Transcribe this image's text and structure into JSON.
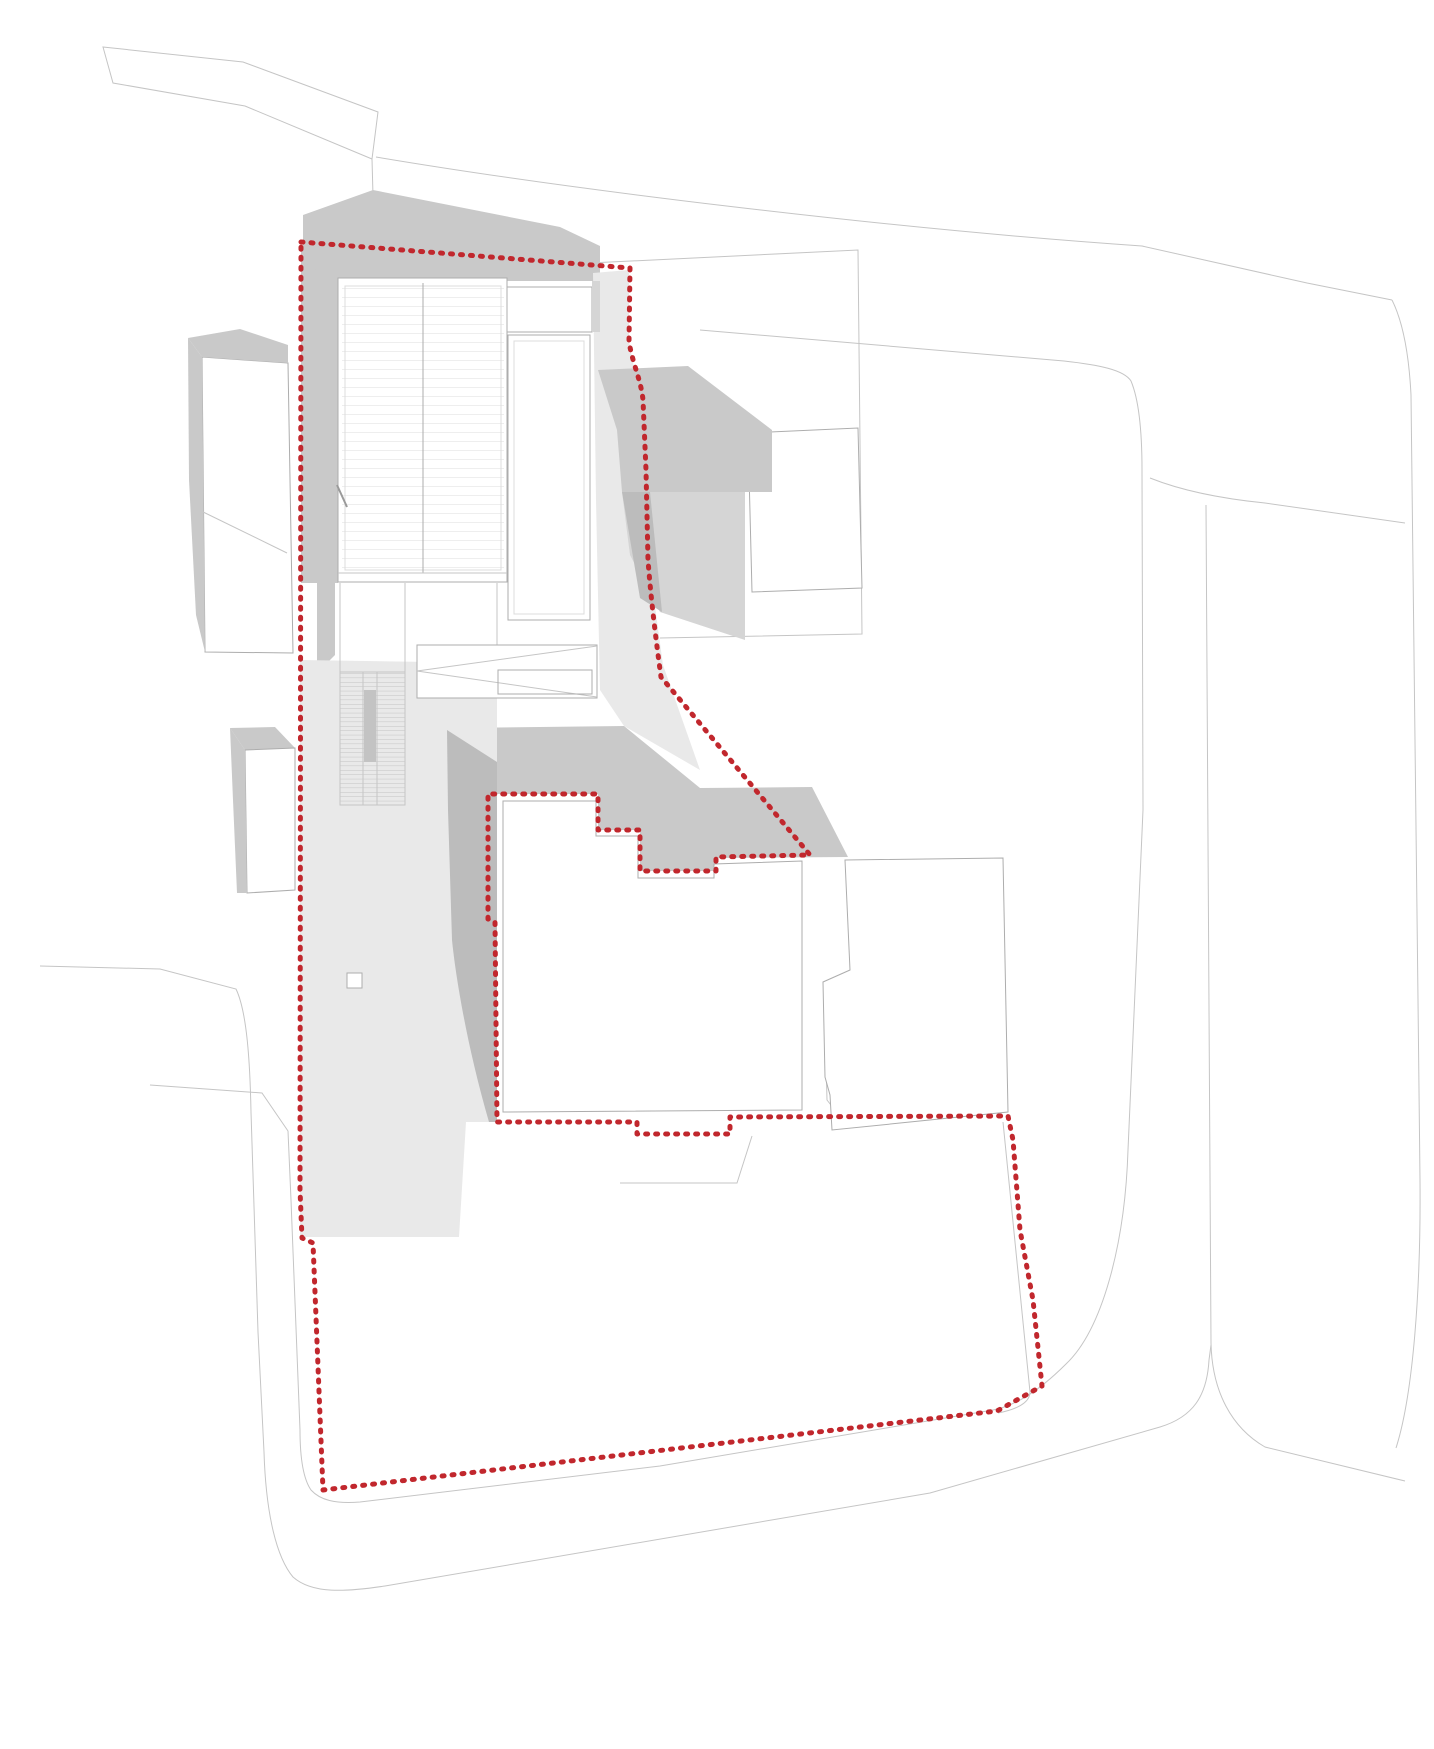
{
  "title": "architectural-site-plan",
  "canvas": {
    "width": 1434,
    "height": 1749,
    "background": "#ffffff"
  },
  "colors": {
    "boundary_red": "#c1272d",
    "outline_thin": "#c5c5c5",
    "outline_building": "#adadad",
    "mass_gray": "#c9c9c9",
    "mass_gray_dark": "#bcbcbc",
    "mass_gray_mid": "#d5d5d5",
    "plaza_light": "#e9e9e9",
    "roof_hatch": "#dcdcdc",
    "stair_tread": "#c3c3c3",
    "white": "#ffffff"
  },
  "legend": {
    "site_boundary_style": "red dashed dotted line",
    "boundary_dash": "2 8",
    "boundary_width": 5
  },
  "shapes": [
    {
      "name": "road-top-strip",
      "kind": "thin",
      "d": "M103,47 L243,62 L378,112 L372,159 L245,106 L113,83 Z"
    },
    {
      "name": "road-top-strip-stub",
      "kind": "thin",
      "d": "M372,159 L374,232"
    },
    {
      "name": "road-north-upper-edge",
      "kind": "thin",
      "d": "M376,157 C560,188 880,228 1142,246 L1307,283 L1392,300"
    },
    {
      "name": "road-east-outer-edge",
      "kind": "thin",
      "d": "M1392,300 C1403,322 1409,355 1411,395 L1418,1000 L1420,1180 C1421,1290 1413,1395 1396,1448"
    },
    {
      "name": "parcel-line-northeast",
      "kind": "thin",
      "d": "M590,263 L858,250 L862,634 L660,638"
    },
    {
      "name": "road-inner-loop",
      "kind": "thin",
      "d": "M700,330 L1064,361 C1100,365 1124,370 1131,381 C1139,400 1142,430 1142,470 L1143,810 L1128,1150 C1125,1245 1102,1330 1066,1364 C1040,1390 1015,1406 993,1410 L660,1466 L360,1502 C335,1504 320,1500 311,1490 C302,1477 300,1450 300,1430 L291,1200 L288,1131 L262,1093 L150,1085"
    },
    {
      "name": "road-east-branch",
      "kind": "thin",
      "d": "M1150,478 C1185,492 1225,499 1265,503 L1405,523"
    },
    {
      "name": "road-east-second-edge",
      "kind": "thin",
      "d": "M1206,505 L1211,1343 C1212,1392 1232,1428 1265,1447 L1405,1481"
    },
    {
      "name": "road-outer-west-south",
      "kind": "thin",
      "d": "M40,966 L160,969 L236,989 C247,1012 250,1062 251,1112 L258,1332 L264,1452 C266,1516 277,1558 293,1577 C312,1594 345,1592 385,1586 L930,1493 L1160,1427 C1193,1417 1207,1396 1209,1360 L1211,1345"
    },
    {
      "name": "parcel-line-southeast",
      "kind": "thin",
      "d": "M1003,1122 L1030,1392 C1030,1402 1018,1409 998,1413"
    },
    {
      "name": "parcel-stub-south-a",
      "kind": "thin",
      "d": "M620,1183 L737,1183 L752,1136"
    },
    {
      "name": "parcel-stub-south-b",
      "kind": "thin",
      "d": "M825,1021 L827,1100 L845,1123"
    },
    {
      "name": "shadow-west-strip",
      "kind": "fill",
      "fill": "mass_gray",
      "d": "M301,245 L338,249 L338,583 L301,583 Z"
    },
    {
      "name": "shadow-west-wedge",
      "kind": "fill",
      "fill": "mass_gray",
      "d": "M317,583 L335,583 L335,655 L327,663 L317,663 Z"
    },
    {
      "name": "shadow-north-peak",
      "kind": "fill",
      "fill": "mass_gray",
      "d": "M303,262 L303,215 L373,190 L560,227 L600,246 L600,281 L338,281 L338,278 L320,272 Z"
    },
    {
      "name": "plaza-east-strip",
      "kind": "fill",
      "fill": "plaza_light",
      "d": "M593,273 L629,270 L629,342 L646,430 L650,570 L663,665 L700,770 L624,726 L600,690 L596,500 Z"
    },
    {
      "name": "house-east-upper",
      "kind": "fillstroke",
      "fill": "white",
      "stroke": "outline_building",
      "d": "M748,433 L858,428 L862,588 L752,592 Z"
    },
    {
      "name": "shadow-east-block",
      "kind": "fill",
      "fill": "mass_gray",
      "d": "M598,370 L688,366 L772,430 L772,492 L622,492 L617,430 Z"
    },
    {
      "name": "shadow-east-light",
      "kind": "fill",
      "fill": "mass_gray_mid",
      "d": "M622,492 L745,492 L745,640 L660,612 L630,555 Z"
    },
    {
      "name": "shadow-east-dark-strip",
      "kind": "fill",
      "fill": "mass_gray_dark",
      "d": "M622,492 L650,492 L662,612 L640,598 Z"
    },
    {
      "name": "shadow-inner-north-band",
      "kind": "fill",
      "fill": "mass_gray",
      "d": "M453,728 L624,726 L700,788 L812,787 L848,857 L716,858 L716,871 L640,871 L640,830 L598,830 L598,794 L488,794 L468,778 Z"
    },
    {
      "name": "plaza-main",
      "kind": "fill",
      "fill": "plaza_light",
      "d": "M300,660 L497,663 L497,1122 L466,1122 L459,1237 L300,1237 Z"
    },
    {
      "name": "shadow-inner-west-wedge",
      "kind": "fill",
      "fill": "mass_gray_dark",
      "d": "M447,730 L497,762 L497,1122 L489,1122 C468,1050 456,980 452,940 L448,810 Z"
    },
    {
      "name": "building-a-face",
      "kind": "fillstroke",
      "fill": "white",
      "stroke": "outline_building",
      "d": "M202,357 L288,363 L293,653 L205,652 Z"
    },
    {
      "name": "building-a-roofline",
      "kind": "thin",
      "d": "M197,509 L287,553"
    },
    {
      "name": "building-a-top-shadow",
      "kind": "fill",
      "fill": "mass_gray",
      "d": "M188,338 L240,329 L288,345 L288,363 L202,357 Z"
    },
    {
      "name": "building-a-left-shadow",
      "kind": "fill",
      "fill": "mass_gray",
      "d": "M188,338 L202,357 L205,652 L196,615 L189,480 Z"
    },
    {
      "name": "building-b-top-shadow",
      "kind": "fill",
      "fill": "mass_gray",
      "d": "M230,728 L275,727 L295,748 L245,750 Z"
    },
    {
      "name": "building-b-face",
      "kind": "fillstroke",
      "fill": "white",
      "stroke": "outline_building",
      "d": "M245,750 L295,748 L295,890 L247,893 Z"
    },
    {
      "name": "building-b-left-shadow",
      "kind": "fill",
      "fill": "mass_gray",
      "d": "M230,728 L245,750 L247,893 L237,893 L233,800 Z"
    },
    {
      "name": "main-building-body",
      "kind": "fillstroke",
      "fill": "white",
      "stroke": "outline_building",
      "d": "M338,278 L507,278 L507,582 L338,582 Z"
    },
    {
      "name": "main-building-roof-hatch",
      "kind": "hatch",
      "d": "M342,283 L504,283 L504,573 L342,573 Z"
    },
    {
      "name": "main-building-parapet",
      "kind": "thinstroke",
      "stroke": "roof_hatch",
      "d": "M345,286 L501,286 L501,570 L345,570 Z"
    },
    {
      "name": "main-building-ridge",
      "kind": "thinstroke",
      "stroke": "outline_building",
      "d": "M423,283 L423,573"
    },
    {
      "name": "main-building-south-line",
      "kind": "thin",
      "d": "M338,573 L507,573"
    },
    {
      "name": "east-wing-top",
      "kind": "fillstroke",
      "fill": "white",
      "stroke": "outline_building",
      "d": "M507,287 L592,287 L592,332 L507,332 Z"
    },
    {
      "name": "east-wing-body",
      "kind": "fillstroke",
      "fill": "white",
      "stroke": "outline_building",
      "d": "M508,335 L590,335 L590,620 L508,620 Z"
    },
    {
      "name": "east-wing-inner",
      "kind": "thinstroke",
      "stroke": "roof_hatch",
      "d": "M514,341 L584,341 L584,614 L514,614 Z"
    },
    {
      "name": "east-wing-seam",
      "kind": "fill",
      "fill": "mass_gray_mid",
      "d": "M592,281 L600,281 L600,332 L592,332 Z"
    },
    {
      "name": "terrace-edge-a",
      "kind": "thin",
      "d": "M340,583 L340,672"
    },
    {
      "name": "terrace-edge-b",
      "kind": "thin",
      "d": "M405,583 L405,805"
    },
    {
      "name": "terrace-edge-c",
      "kind": "thin",
      "d": "M497,583 L497,663"
    },
    {
      "name": "canopy-plate",
      "kind": "fillstroke",
      "fill": "white",
      "stroke": "outline_building",
      "d": "M417,645 L597,645 L597,698 L417,698 Z"
    },
    {
      "name": "canopy-fold-a",
      "kind": "thin",
      "d": "M417,671 L597,646"
    },
    {
      "name": "canopy-fold-b",
      "kind": "thin",
      "d": "M417,671 L597,697"
    },
    {
      "name": "canopy-inner",
      "kind": "thinstroke",
      "stroke": "outline_building",
      "d": "M498,670 L592,670 L592,694 L498,694 Z"
    },
    {
      "name": "stair-run",
      "kind": "stairs",
      "d": "M340,672 L405,672 L405,805 L340,805 Z"
    },
    {
      "name": "stair-rail-a",
      "kind": "thin",
      "d": "M363,672 L363,805"
    },
    {
      "name": "stair-rail-b",
      "kind": "thin",
      "d": "M377,672 L377,805"
    },
    {
      "name": "stair-landing",
      "kind": "fill",
      "fill": "stair_tread",
      "d": "M364,690 L376,690 L376,762 L364,762 Z"
    },
    {
      "name": "plaza-kiosk",
      "kind": "fillstroke",
      "fill": "white",
      "stroke": "outline_building",
      "d": "M347,973 L362,973 L362,988 L347,988 Z"
    },
    {
      "name": "downspout-tick",
      "kind": "tick",
      "d": "M337,485 L347,507"
    },
    {
      "name": "house-inner-west",
      "kind": "fillstroke",
      "fill": "white",
      "stroke": "outline_building",
      "d": "M503,801 L596,801 L596,836 L638,836 L638,878 L714,878 L714,864 L802,861 L802,1110 L503,1112 Z"
    },
    {
      "name": "house-inner-east",
      "kind": "fillstroke",
      "fill": "white",
      "stroke": "outline_building",
      "d": "M845,860 L1003,858 L1008,1112 L832,1130 L830,1095 L825,1077 L823,982 L850,970 Z"
    },
    {
      "name": "site-boundary",
      "kind": "boundary",
      "d": "M301,242 L630,268 L629,342 C633,365 641,380 643,400 L646,470 L648,560 C651,600 656,640 661,677 L810,855 L716,857 L716,871 L640,871 L640,830 L598,830 L598,794 L488,794 L488,919 L495,922 L497,1122 L637,1122 L637,1134 L730,1134 L730,1117 L1008,1116 L1013,1140 L1020,1230 L1033,1300 L1042,1386 L997,1411 L323,1490 L313,1243 L302,1238 L300,1190 Z"
    }
  ]
}
